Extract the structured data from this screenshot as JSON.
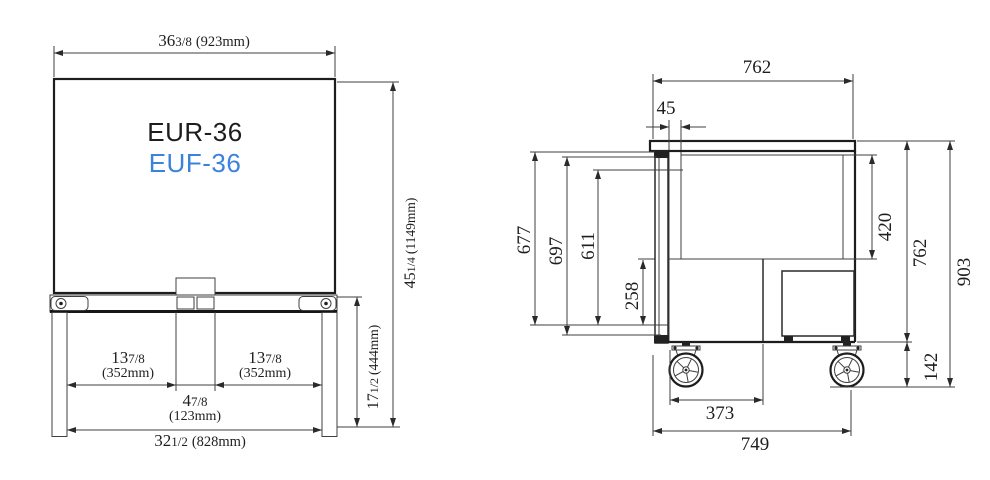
{
  "page": {
    "background": "#ffffff",
    "line_color": "#3f3f3f"
  },
  "models": {
    "primary": {
      "label": "EUR-36",
      "color": "#1d1d1f"
    },
    "secondary": {
      "label": "EUF-36",
      "color": "#3b82dd"
    }
  },
  "front_view": {
    "dims": {
      "top_width": {
        "whole": "36",
        "frac": "3/8",
        "metric": "(923mm)"
      },
      "overall_height": {
        "whole": "45",
        "frac": "1/4",
        "metric": "(1149mm)"
      },
      "left_span": {
        "whole": "13",
        "frac": "7/8",
        "metric": "(352mm)"
      },
      "right_span": {
        "whole": "13",
        "frac": "7/8",
        "metric": "(352mm)"
      },
      "center_span": {
        "whole": "4",
        "frac": "7/8",
        "metric": "(123mm)"
      },
      "base_width": {
        "whole": "32",
        "frac": "1/2",
        "metric": "(828mm)"
      },
      "leg_height": {
        "whole": "17",
        "frac": "1/2",
        "metric": "(444mm)"
      }
    }
  },
  "side_view": {
    "dims": {
      "top_depth": "762",
      "overhang": "45",
      "h677": "677",
      "h697": "697",
      "h611": "611",
      "h258": "258",
      "interior_height": "420",
      "body_height": "762",
      "overall_height": "903",
      "caster_height": "142",
      "caster_span": "373",
      "base_depth": "749"
    }
  }
}
